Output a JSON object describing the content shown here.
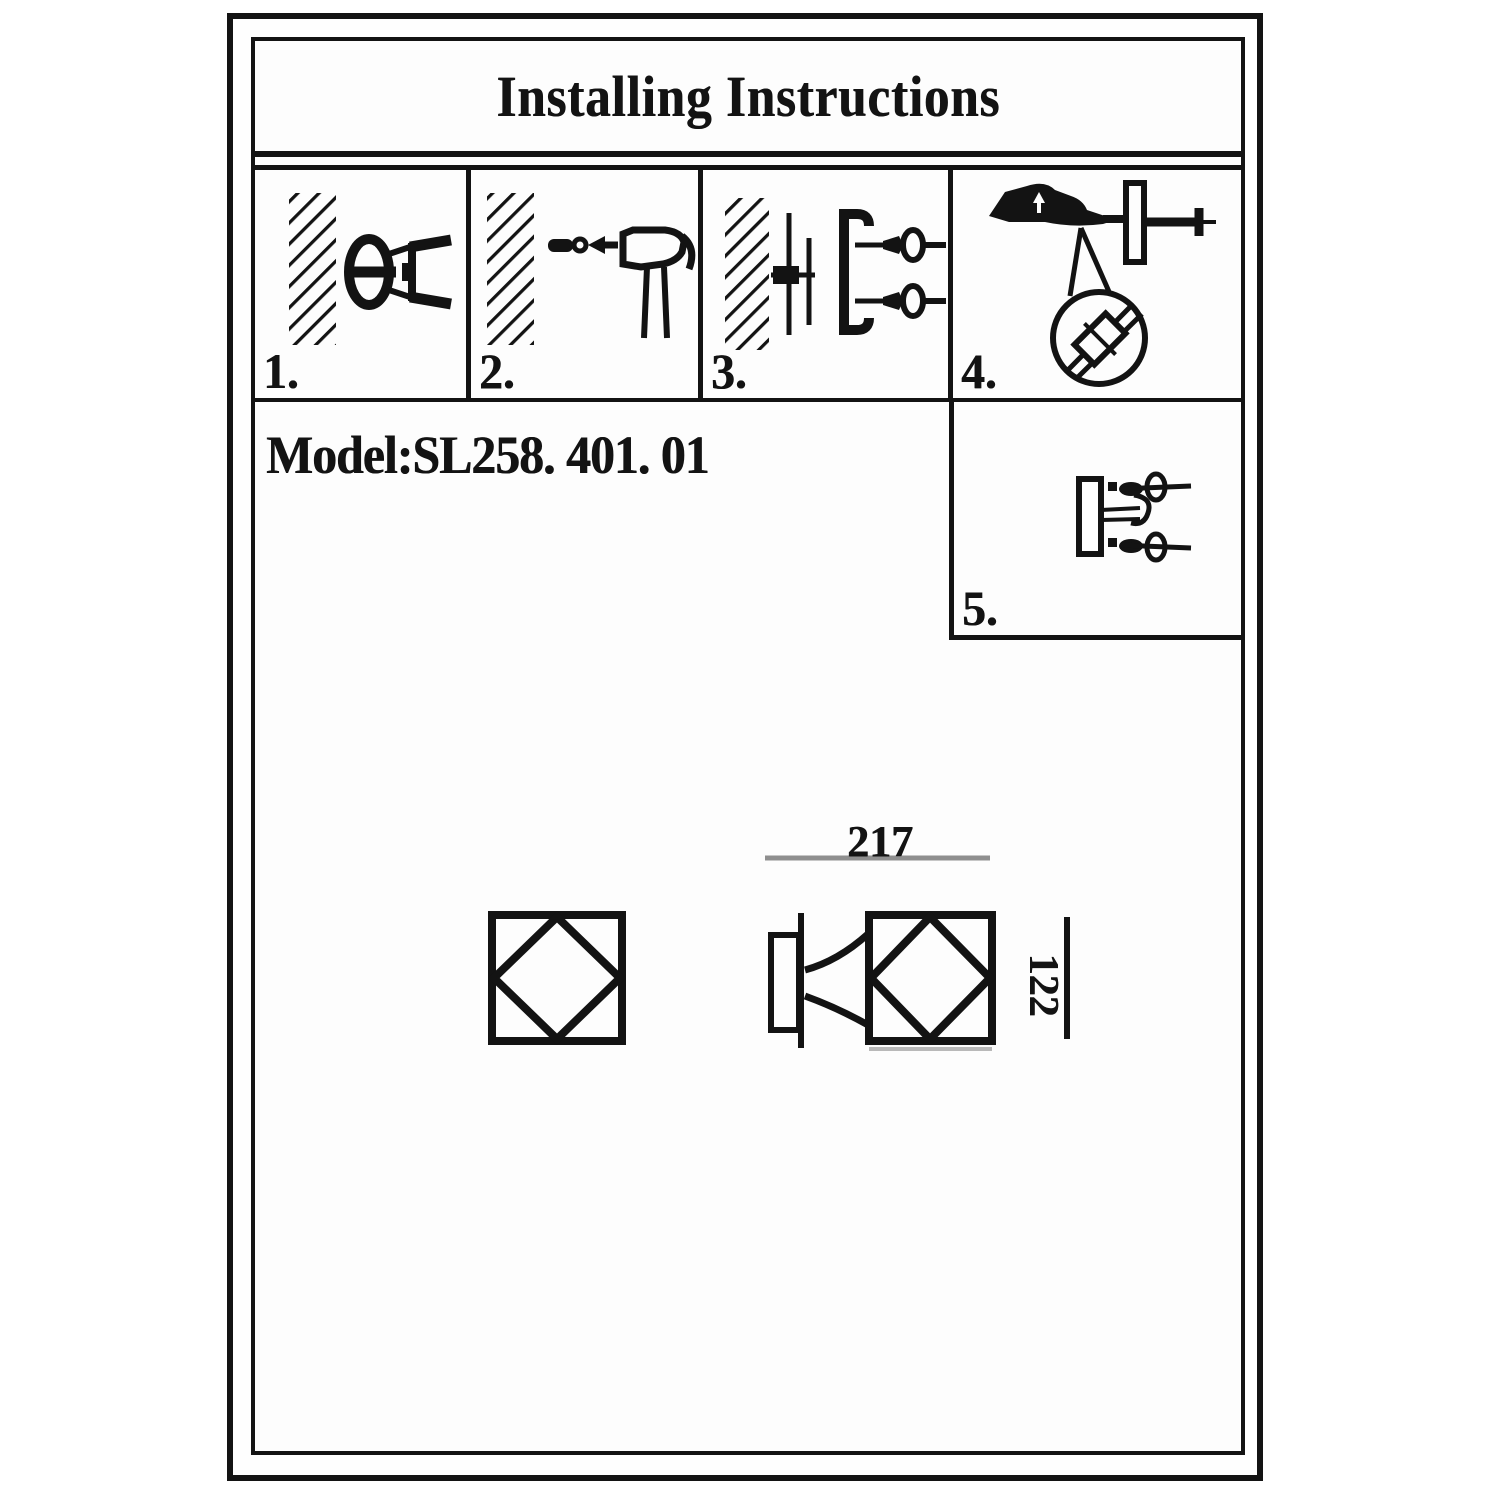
{
  "header": {
    "title": "Installing Instructions"
  },
  "model_line": {
    "text": "Model:SL258. 401. 01"
  },
  "steps": [
    {
      "label": "1.",
      "icon": "drill-hole-in-wall-icon"
    },
    {
      "label": "2.",
      "icon": "hammer-anchor-into-wall-icon"
    },
    {
      "label": "3.",
      "icon": "screw-bracket-to-wall-icon"
    },
    {
      "label": "4.",
      "icon": "wire-connection-detail-icon"
    },
    {
      "label": "5.",
      "icon": "tighten-fixture-screws-icon"
    }
  ],
  "dimensions": {
    "width": "217",
    "height": "122"
  },
  "colors": {
    "ink": "#131313",
    "dimension_line_gray": "#8f8f8f",
    "faint_line_gray": "#b9b9b9",
    "paper": "#ffffff"
  }
}
